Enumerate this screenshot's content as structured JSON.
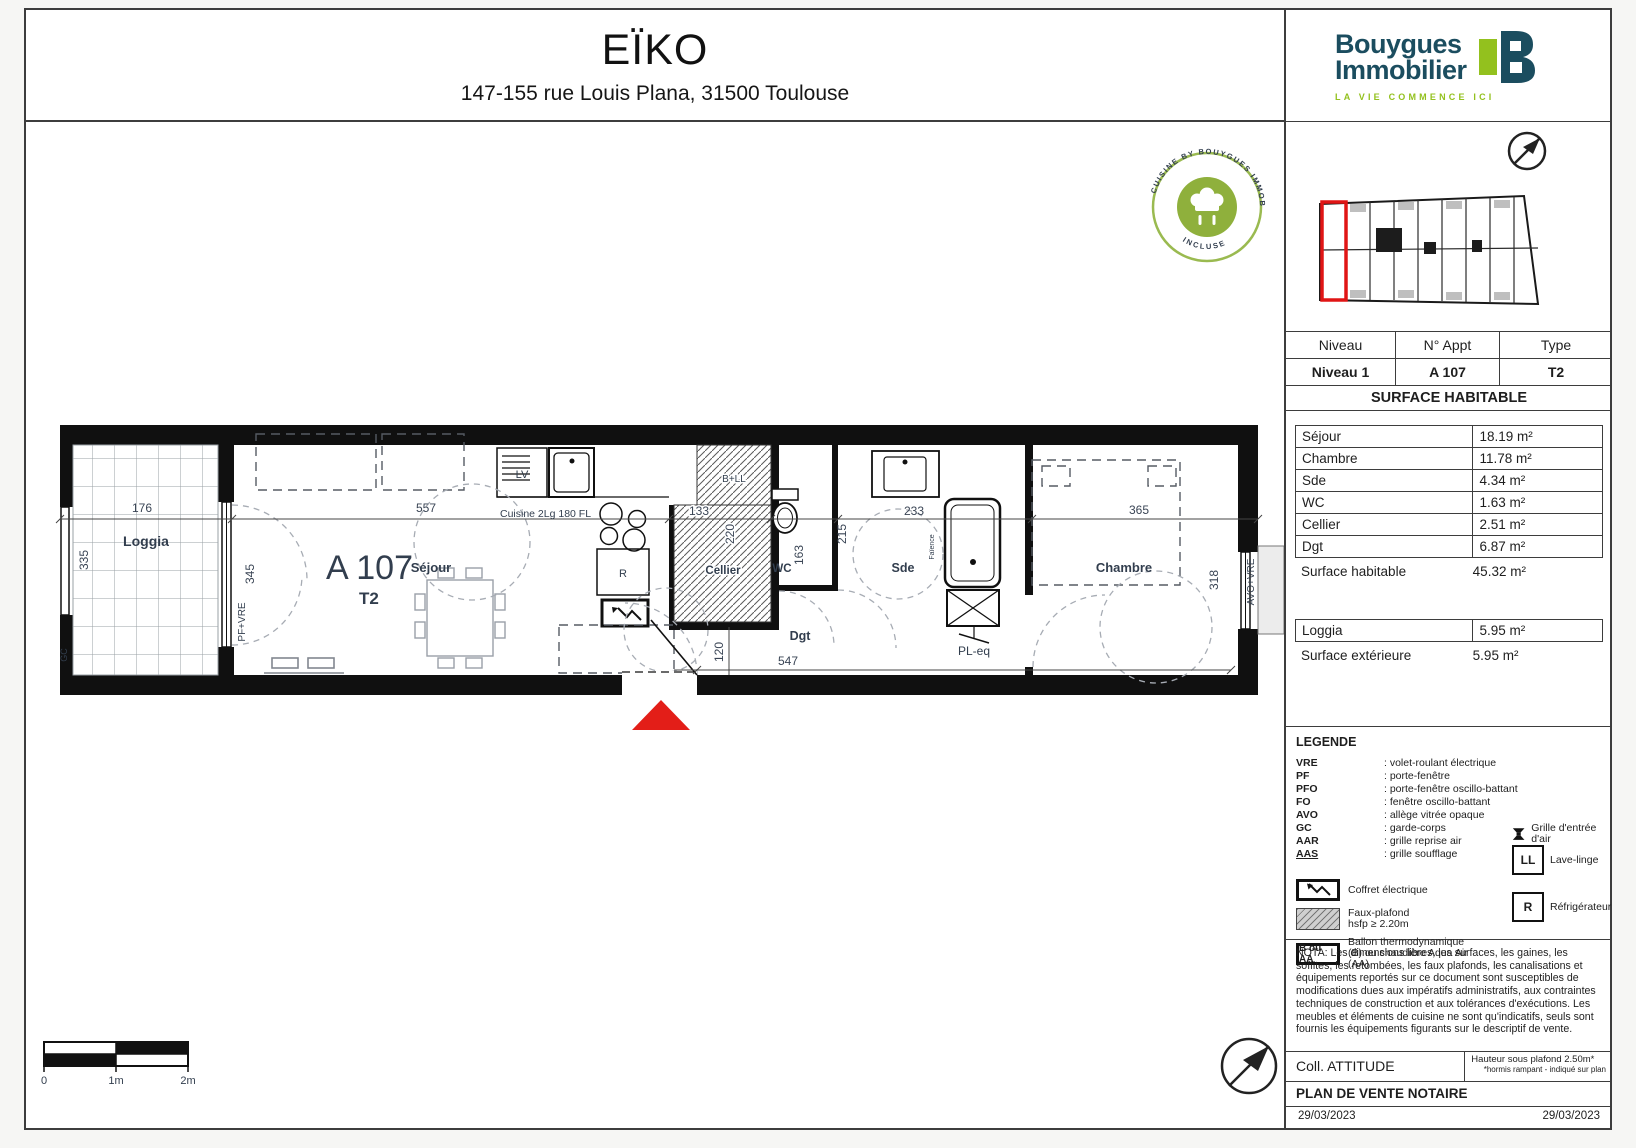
{
  "header": {
    "title": "EÏKO",
    "address": "147-155 rue Louis Plana, 31500 Toulouse"
  },
  "logo": {
    "word1": "Bouygues",
    "word2": "Immobilier",
    "tagline": "LA VIE COMMENCE ICI",
    "navy": "#1b4d5f",
    "green": "#93c11e"
  },
  "stamp": {
    "arc_top": "CUISINE BY BOUYGUES IMMOBILIER",
    "arc_bottom": "INCLUSE",
    "color": "#95b747"
  },
  "info_table": {
    "headers": [
      "Niveau",
      "N° Appt",
      "Type"
    ],
    "values": [
      "Niveau 1",
      "A 107",
      "T2"
    ]
  },
  "surface_table": {
    "title": "SURFACE HABITABLE",
    "rows": [
      {
        "label": "Séjour",
        "value": "18.19 m²"
      },
      {
        "label": "Chambre",
        "value": "11.78 m²"
      },
      {
        "label": "Sde",
        "value": "4.34 m²"
      },
      {
        "label": "WC",
        "value": "1.63 m²"
      },
      {
        "label": "Cellier",
        "value": "2.51 m²"
      },
      {
        "label": "Dgt",
        "value": "6.87 m²"
      }
    ],
    "total_label": "Surface habitable",
    "total_value": "45.32 m²"
  },
  "exterior_table": {
    "row_label": "Loggia",
    "row_value": "5.95 m²",
    "total_label": "Surface extérieure",
    "total_value": "5.95 m²"
  },
  "legend": {
    "title": "LEGENDE",
    "abbreviations": [
      {
        "abbr": "VRE",
        "desc": ": volet-roulant électrique"
      },
      {
        "abbr": "PF",
        "desc": ": porte-fenêtre"
      },
      {
        "abbr": "PFO",
        "desc": ": porte-fenêtre oscillo-battant"
      },
      {
        "abbr": "FO",
        "desc": ": fenêtre oscillo-battant"
      },
      {
        "abbr": "AVO",
        "desc": ": allège vitrée opaque"
      },
      {
        "abbr": "GC",
        "desc": ": garde-corps"
      },
      {
        "abbr": "AAR",
        "desc": ": grille reprise air"
      },
      {
        "abbr": "AAS",
        "desc": ": grille soufflage"
      }
    ],
    "grille_label": "Grille d'entrée d'air",
    "coffret_label": "Coffret électrique",
    "fauxplafond_label1": "Faux-plafond",
    "fauxplafond_label2": "hsfp ≥ 2.20m",
    "ballon_key": "B ou AA",
    "ballon_label": "Ballon thermodynamique (B) ou chaudière Aqua Air (AA)",
    "ll_key": "LL",
    "ll_label": "Lave-linge",
    "r_key": "R",
    "r_label": "Réfrigérateur"
  },
  "nota": "NOTA: Les dimensions libres, les surfaces, les gaines, les soffites, les retombées, les faux plafonds, les canalisations et équipements reportés sur ce document sont susceptibles de modifications dues aux impératifs administratifs, aux contraintes techniques de construction et aux tolérances d'exécutions. Les meubles et éléments de cuisine ne sont qu'indicatifs, seuls sont fournis les équipements figurants sur le descriptif de vente.",
  "footer": {
    "collection": "Coll. ATTITUDE",
    "ceiling": "Hauteur sous plafond 2.50m*",
    "ceiling_note": "*hormis rampant - indiqué sur plan",
    "doc_type": "PLAN DE VENTE NOTAIRE",
    "date_left": "29/03/2023",
    "date_right": "29/03/2023"
  },
  "plan": {
    "unit_number": "A 107",
    "unit_type": "T2",
    "rooms": {
      "loggia": "Loggia",
      "sejour": "Séjour",
      "cellier": "Cellier",
      "wc": "WC",
      "dgt": "Dgt",
      "sde": "Sde",
      "chambre": "Chambre"
    },
    "labels": {
      "lv": "LV",
      "cuisine": "Cuisine 2Lg 180 FL",
      "fridge": "R",
      "b_ll": "B+LL",
      "pf_vre": "PF+VRE",
      "avo_vre": "AVO+VRE",
      "gc": "GC",
      "faience": "Faïence",
      "pl_eq": "PL-eq"
    },
    "dims": {
      "d176": "176",
      "d335": "335",
      "d345": "345",
      "d557": "557",
      "d133": "133",
      "d220": "220",
      "d163": "163",
      "d215": "215",
      "d233": "233",
      "d365": "365",
      "d318": "318",
      "d547": "547",
      "d120": "120"
    }
  },
  "scalebar": {
    "t0": "0",
    "t1": "1m",
    "t2": "2m"
  }
}
